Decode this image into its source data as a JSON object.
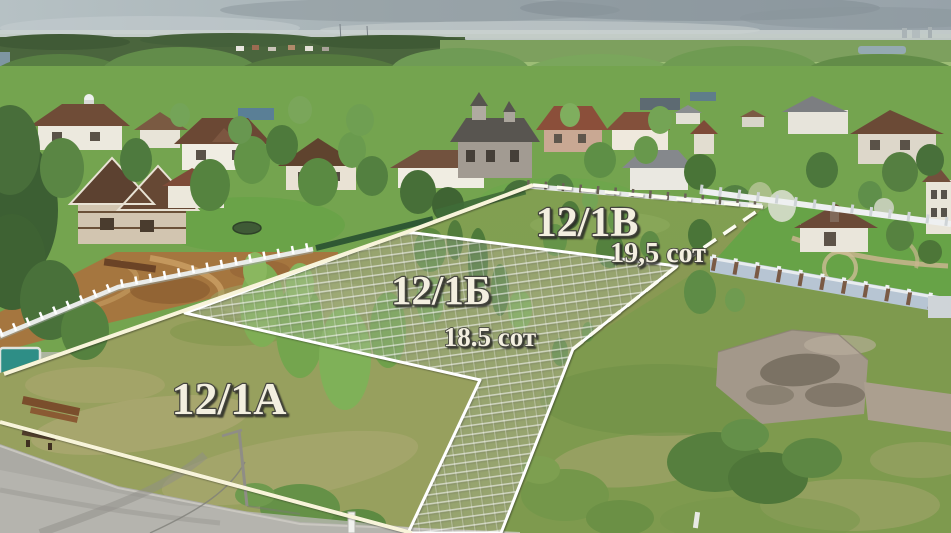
{
  "plots": [
    {
      "label": "12/1A"
    },
    {
      "label": "12/1Б",
      "area": "18.5 сот"
    },
    {
      "label": "12/1В",
      "area": "19,5 сот"
    }
  ],
  "colors": {
    "boundary_solid": "#f8f4da",
    "boundary_white": "#ffffff",
    "boundary_dashed": "#fcfcf2",
    "label_fill": "#f3efe0",
    "label_outline": "#45453f"
  }
}
